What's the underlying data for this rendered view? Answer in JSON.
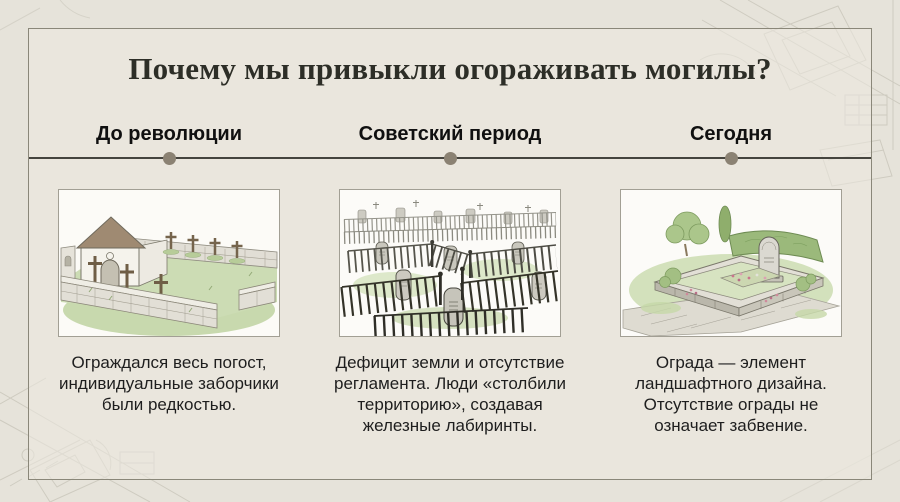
{
  "slide": {
    "title": "Почему мы привыкли огораживать могилы?"
  },
  "timeline": {
    "periods": [
      {
        "label": "До революции",
        "caption": "Ограждался весь погост,\nиндивидуальные заборчики\nбыли редкостью.",
        "illustration": "walled-churchyard-with-wooden-crosses"
      },
      {
        "label": "Советский период",
        "caption": "Дефицит земли и отсутствие\nрегламента. Люди «столбили\nтерриторию», создавая\nжелезные лабиринты.",
        "illustration": "iron-fence-grave-labyrinth"
      },
      {
        "label": "Сегодня",
        "caption": "Ограда — элемент\nландшафтного дизайна.\nОтсутствие ограды не\nозначает забвение.",
        "illustration": "landscaped-modern-grave-plot"
      }
    ]
  },
  "colors": {
    "background": "#e6e3da",
    "panel_border": "#8a8779",
    "title_text": "#2d2e27",
    "heading_text": "#101010",
    "body_text": "#1e1e1e",
    "timeline_line": "#45443e",
    "timeline_dot": "#8b8273",
    "image_frame_border": "#a29f94",
    "image_frame_bg": "#fcfbf7",
    "blueprint_lines": "#c7c4b8"
  }
}
